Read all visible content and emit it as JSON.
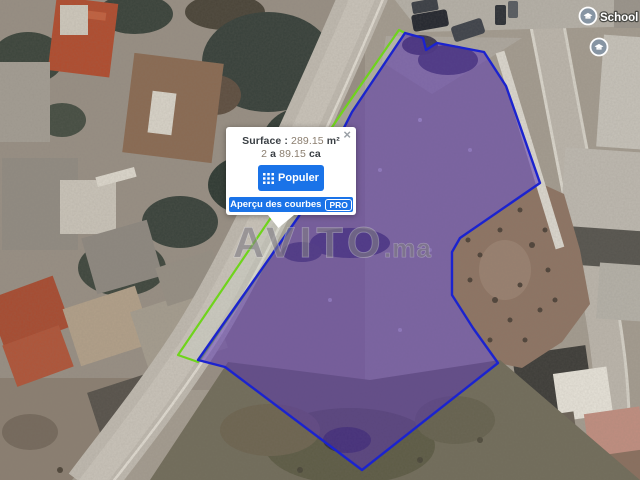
{
  "map": {
    "watermark_main": "AVITO",
    "watermark_suffix": ".ma",
    "poi_label": "School Ain",
    "colors": {
      "plot_outline_blue": "#1b23cf",
      "plot_fill_purple": "rgba(88,52,176,0.52)",
      "strip_outline_green": "#6fd41c",
      "button_blue": "#1a73e8",
      "poi_icon_gray": "#8795a3"
    }
  },
  "popup": {
    "close_label": "×",
    "surface_label": "Surface :",
    "surface_value": "289.15",
    "surface_unit": "m²",
    "area_value_1": "2",
    "area_unit_1": "a",
    "area_value_2": "89.15",
    "area_unit_2": "ca",
    "populer_label": "Populer",
    "apercu_label": "Aperçu des courbes",
    "pro_badge": "PRO"
  }
}
